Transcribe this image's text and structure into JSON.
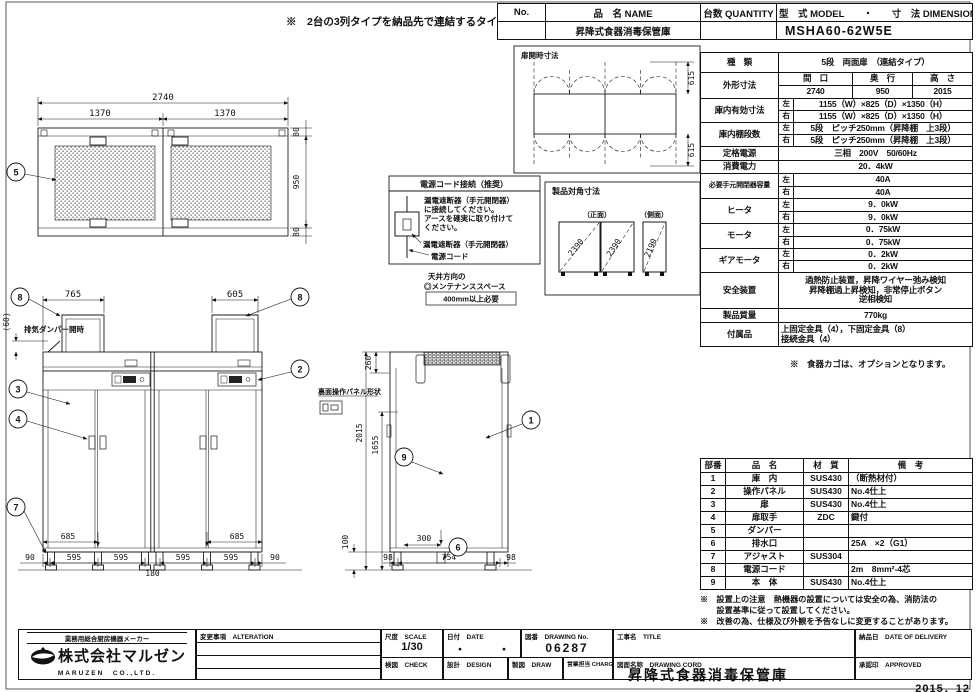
{
  "top_note": "※　2台の3列タイプを納品先で連結するタイプです。",
  "header": {
    "no_label": "No.",
    "name_label": "品　名 NAME",
    "qty_label": "台数 QUANTITY",
    "model_label": "型　式 MODEL　　・　　寸　法 DIMENSION",
    "name_value": "昇降式食器消毒保管庫",
    "model_value": "MSHA60-62W5E"
  },
  "spec": {
    "left": "左",
    "right": "右",
    "kind_label": "種　類",
    "kind_value": "5段　両面扉　（連結タイプ）",
    "outer_label": "外形寸法",
    "outer_w_label": "間　口",
    "outer_d_label": "奥　行",
    "outer_h_label": "高　さ",
    "outer_w": "2740",
    "outer_d": "950",
    "outer_h": "2015",
    "inner_label": "庫内有効寸法",
    "inner_left": "1155（W）×825（D）×1350（H）",
    "inner_right": "1155（W）×825（D）×1350（H）",
    "shelf_label": "庫内棚段数",
    "shelf_left": "5段　ピッチ250mm（昇降棚　上3段）",
    "shelf_right": "5段　ピッチ250mm（昇降棚　上3段）",
    "power_label": "定格電源",
    "power_value": "三相　200V　50/60Hz",
    "watt_label": "消費電力",
    "watt_value": "20．4kW",
    "breaker_label": "必要手元開閉器容量",
    "breaker_left": "40A",
    "breaker_right": "40A",
    "heater_label": "ヒータ",
    "heater_left": "9．0kW",
    "heater_right": "9．0kW",
    "motor_label": "モータ",
    "motor_left": "0．75kW",
    "motor_right": "0．75kW",
    "gear_label": "ギアモータ",
    "gear_left": "0．2kW",
    "gear_right": "0．2kW",
    "safety_label": "安全装置",
    "safety_line1": "過熱防止装置，昇降ワイヤー弛み検知",
    "safety_line2": "昇降棚過上昇検知，非常停止ボタン",
    "safety_line3": "逆相検知",
    "weight_label": "製品質量",
    "weight_value": "770kg",
    "acc_label": "付属品",
    "acc_line1": "上固定金具（4），下固定金具（8）",
    "acc_line2": "接続金具（4）",
    "option_note": "※　食器カゴは、オプションとなります。"
  },
  "parts": {
    "no_h": "部番",
    "name_h": "品　名",
    "mat_h": "材　質",
    "rmk_h": "備　考",
    "rows": [
      {
        "no": "1",
        "name": "庫　内",
        "mat": "SUS430",
        "rmk": "（断熱材付）"
      },
      {
        "no": "2",
        "name": "操作パネル",
        "mat": "SUS430",
        "rmk": "No.4仕上"
      },
      {
        "no": "3",
        "name": "扉",
        "mat": "SUS430",
        "rmk": "No.4仕上"
      },
      {
        "no": "4",
        "name": "扉取手",
        "mat": "ZDC",
        "rmk": "鍵付"
      },
      {
        "no": "5",
        "name": "ダンパー",
        "mat": "",
        "rmk": ""
      },
      {
        "no": "6",
        "name": "排水口",
        "mat": "",
        "rmk": "25A　×2（G1）"
      },
      {
        "no": "7",
        "name": "アジャスト",
        "mat": "SUS304",
        "rmk": ""
      },
      {
        "no": "8",
        "name": "電源コード",
        "mat": "",
        "rmk": "2m　8mm²-4芯"
      },
      {
        "no": "9",
        "name": "本　体",
        "mat": "SUS430",
        "rmk": "No.4仕上"
      }
    ]
  },
  "notes": {
    "line1": "※　設置上の注意　熱機器の設置については安全の為、消防法の",
    "line2": "　　設置基準に従って設置してください。",
    "line3": "※　改善の為、仕様及び外観を予告なしに変更することがあります。"
  },
  "titleblock": {
    "maker_tag": "業務用総合厨房機器メーカー",
    "maker_name": "株式会社マルゼン",
    "maker_en": "MARUZEN　CO.,LTD.",
    "alteration_label": "変更事項　ALTERATION",
    "scale_label": "尺度　SCALE",
    "scale_value": "1/30",
    "date_label": "日付　DATE",
    "date_value": "・　　　・",
    "dwgno_label": "図番　DRAWING No.",
    "dwgno_value": "06287",
    "check_label": "検図　CHECK",
    "design_label": "設計　DESIGN",
    "draw_label": "製図　DRAW",
    "charge_label": "営業担当 CHARGE",
    "title_label": "工事名　TITLE",
    "dwgname_label": "図面名称　DRAWING CORD",
    "dwgname_value": "昇降式食器消毒保管庫",
    "delivery_label": "納品日　DATE OF DELIVERY",
    "approved_label": "承認印　APPROVED",
    "issue_date": "2015．12"
  },
  "drawings": {
    "balloons": {
      "b1": "1",
      "b2": "2",
      "b3": "3",
      "b4": "4",
      "b5": "5",
      "b6": "6",
      "b7": "7",
      "b8": "8",
      "b9": "9"
    },
    "plan": {
      "w_total": "2740",
      "w_half1": "1370",
      "w_half2": "1370",
      "d_top": "80",
      "d_mid": "950",
      "d_bot": "80"
    },
    "door_open": {
      "title": "扉開時寸法",
      "dim_top": "615",
      "dim_bot": "615"
    },
    "cord": {
      "title": "電源コード接続（推奨）",
      "body1": "漏電遮断器（手元開閉器）",
      "body2": "に接続してください。",
      "body3": "アースを確実に取り付けて",
      "body4": "ください。",
      "label_breaker": "漏電遮断器（手元開閉器）",
      "label_cord": "電源コード"
    },
    "diag": {
      "title": "製品対角寸法",
      "front_label": "（正面）",
      "side_label": "（側面）",
      "d1": "2390",
      "d2": "2390",
      "d3": "2190"
    },
    "front": {
      "dim_pipe_left": "765",
      "dim_pipe_right": "605",
      "dim_damper": "(60)",
      "damper_note": "排気ダンパー開時",
      "panel_note": "裏面操作パネル形状",
      "dim_drain_l": "685",
      "dim_drain_r": "685",
      "chain": [
        "90",
        "595",
        "595",
        "180",
        "595",
        "595",
        "90"
      ]
    },
    "side": {
      "dim_260": "260",
      "dim_2015": "2015",
      "dim_1655": "1655",
      "dim_100": "100",
      "dim_300": "300",
      "chain": [
        "98",
        "754",
        "98"
      ],
      "maint_line1": "天井方向の",
      "maint_line2": "◎メンテナンススペース",
      "maint_line3": "400mm以上必要"
    }
  }
}
